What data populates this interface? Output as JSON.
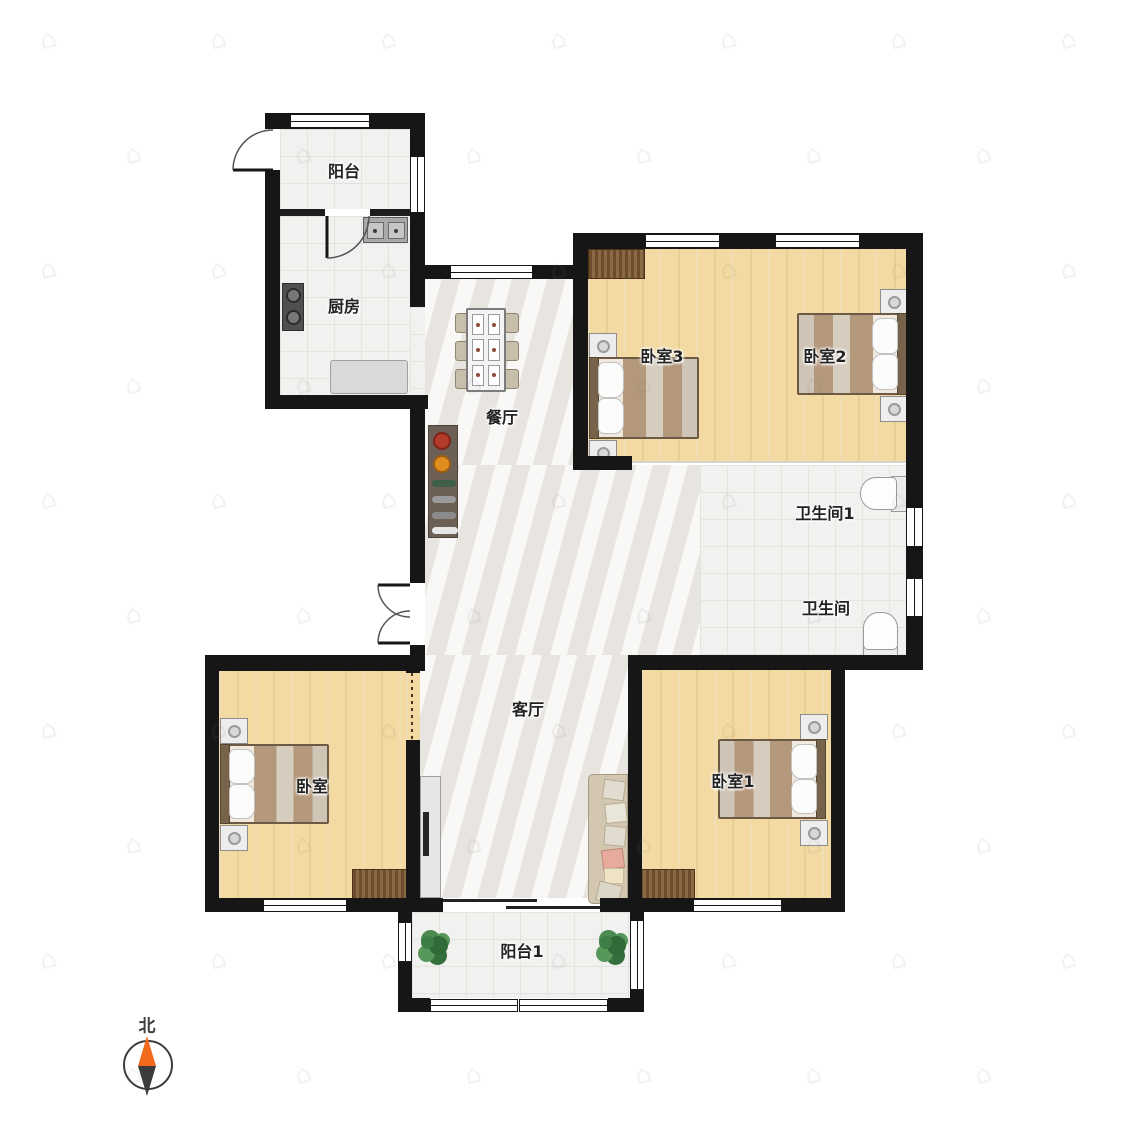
{
  "plan": {
    "rooms": {
      "balcony_top": {
        "label": "阳台"
      },
      "kitchen": {
        "label": "厨房"
      },
      "dining": {
        "label": "餐厅"
      },
      "bedroom3": {
        "label": "卧室3"
      },
      "bedroom2": {
        "label": "卧室2"
      },
      "bath1": {
        "label": "卫生间1"
      },
      "bath2": {
        "label": "卫生间"
      },
      "living": {
        "label": "客厅"
      },
      "bedroom_bl": {
        "label": "卧室"
      },
      "bedroom1": {
        "label": "卧室1"
      },
      "balcony_bottom": {
        "label": "阳台1"
      }
    },
    "compass": {
      "label": "北"
    },
    "watermark": {
      "symbol": "⌂"
    },
    "colors": {
      "wall": "#161616",
      "wood_floor": "#f3d9a2",
      "tile_floor": "#f1f1ef",
      "marble_floor": "#f1efec",
      "radiator": "#7a5a38",
      "compass_north": "#f26a1b",
      "compass_south": "#3b3b3b",
      "plant_green": "#3f7d46",
      "bed_blanket": "#b4987b"
    }
  }
}
